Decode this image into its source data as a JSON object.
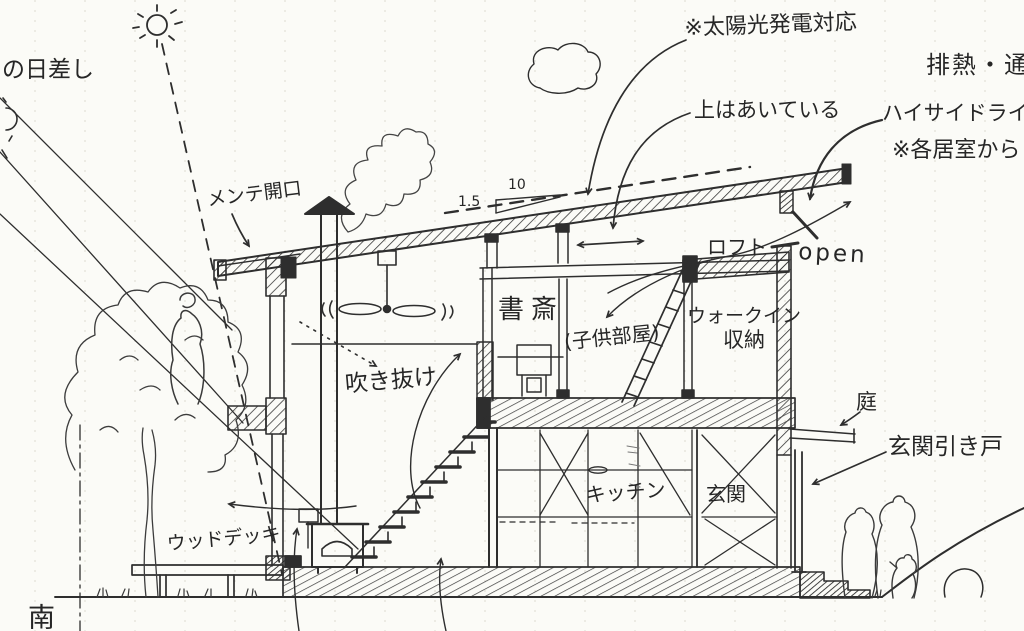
{
  "colors": {
    "ink": "#2e2e2e",
    "paper": "#fbfbf7",
    "grid_line": "#dcdbd2"
  },
  "labels": {
    "sun_note": "の日差し",
    "solar_panel_note": "※太陽光発電対応",
    "top_open_note": "上はあいている",
    "exhaust_note": "排熱・通",
    "high_side_light": "ハイサイドライト",
    "each_room_note": "※各居室から",
    "maintenance_opening": "メンテ開口",
    "slope_run": "10",
    "slope_rise": "1.5",
    "loft": "ロフト",
    "open": "open",
    "study": "書斎",
    "kids_room": "(子供部屋)",
    "walk_in_line1": "ウォークイン",
    "walk_in_line2": "収納",
    "void_space": "吹き抜け",
    "garden": "庭",
    "entrance_sliding_door": "玄関引き戸",
    "kitchen": "キッチン",
    "entrance": "玄関",
    "wood_deck": "ウッドデッキ",
    "south": "南"
  }
}
